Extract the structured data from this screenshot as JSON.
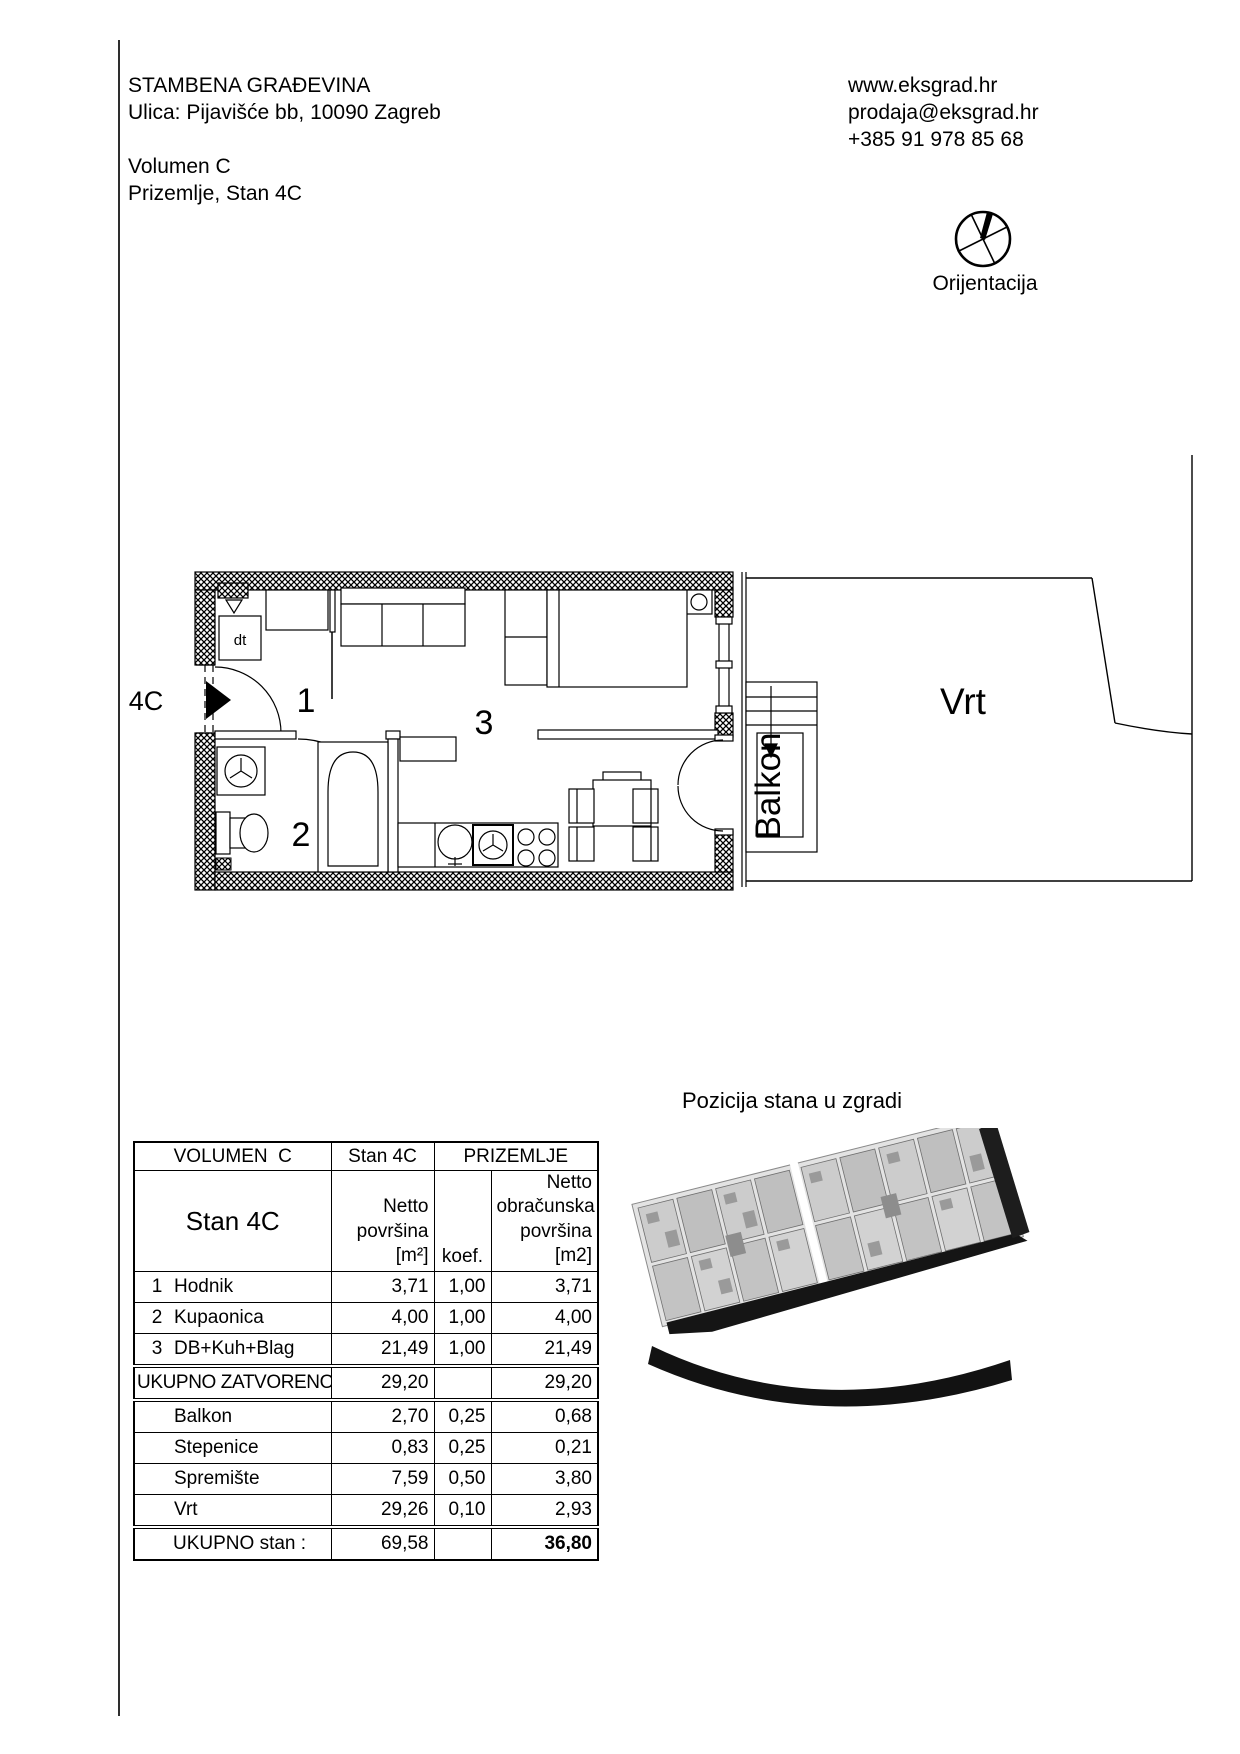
{
  "colors": {
    "ink": "#000000",
    "background": "#ffffff"
  },
  "header": {
    "title": "STAMBENA GRAĐEVINA",
    "address": "Ulica: Pijavišće bb, 10090 Zagreb",
    "volume": "Volumen C",
    "floor_apartment": "Prizemlje, Stan 4C"
  },
  "contact": {
    "website": "www.eksgrad.hr",
    "email": "prodaja@eksgrad.hr",
    "phone": "+385 91 978 85 68"
  },
  "orientation": {
    "label": "Orijentacija"
  },
  "floor_plan": {
    "unit_label": "4C",
    "closet_label": "dt",
    "rooms": {
      "hall_number": "1",
      "bath_number": "2",
      "living_number": "3"
    },
    "balcony_label": "Balkon",
    "garden_label": "Vrt"
  },
  "position_section": {
    "title": "Pozicija stana u zgradi"
  },
  "table": {
    "col_header": {
      "volume": "VOLUMEN  C",
      "unit": "Stan 4C",
      "floor": "PRIZEMLJE"
    },
    "sub_header": {
      "unit_big": "Stan 4C",
      "netto_l1": "Netto",
      "netto_l2": "površina",
      "netto_l3": "[m²]",
      "koef": "koef.",
      "obr_l1": "Netto",
      "obr_l2": "obračunska",
      "obr_l3": "površina",
      "obr_l4": "[m2]"
    },
    "rows": [
      {
        "num": "1",
        "name": "Hodnik",
        "netto": "3,71",
        "koef": "1,00",
        "obr": "3,71"
      },
      {
        "num": "2",
        "name": "Kupaonica",
        "netto": "4,00",
        "koef": "1,00",
        "obr": "4,00"
      },
      {
        "num": "3",
        "name": "DB+Kuh+Blag",
        "netto": "21,49",
        "koef": "1,00",
        "obr": "21,49"
      }
    ],
    "subtotal": {
      "label": "UKUPNO ZATVORENO :",
      "netto": "29,20",
      "obr": "29,20"
    },
    "extra": [
      {
        "name": "Balkon",
        "netto": "2,70",
        "koef": "0,25",
        "obr": "0,68"
      },
      {
        "name": "Stepenice",
        "netto": "0,83",
        "koef": "0,25",
        "obr": "0,21"
      },
      {
        "name": "Spremište",
        "netto": "7,59",
        "koef": "0,50",
        "obr": "3,80"
      },
      {
        "name": "Vrt",
        "netto": "29,26",
        "koef": "0,10",
        "obr": "2,93"
      }
    ],
    "total": {
      "label": "UKUPNO stan :",
      "netto": "69,58",
      "obr": "36,80"
    }
  }
}
